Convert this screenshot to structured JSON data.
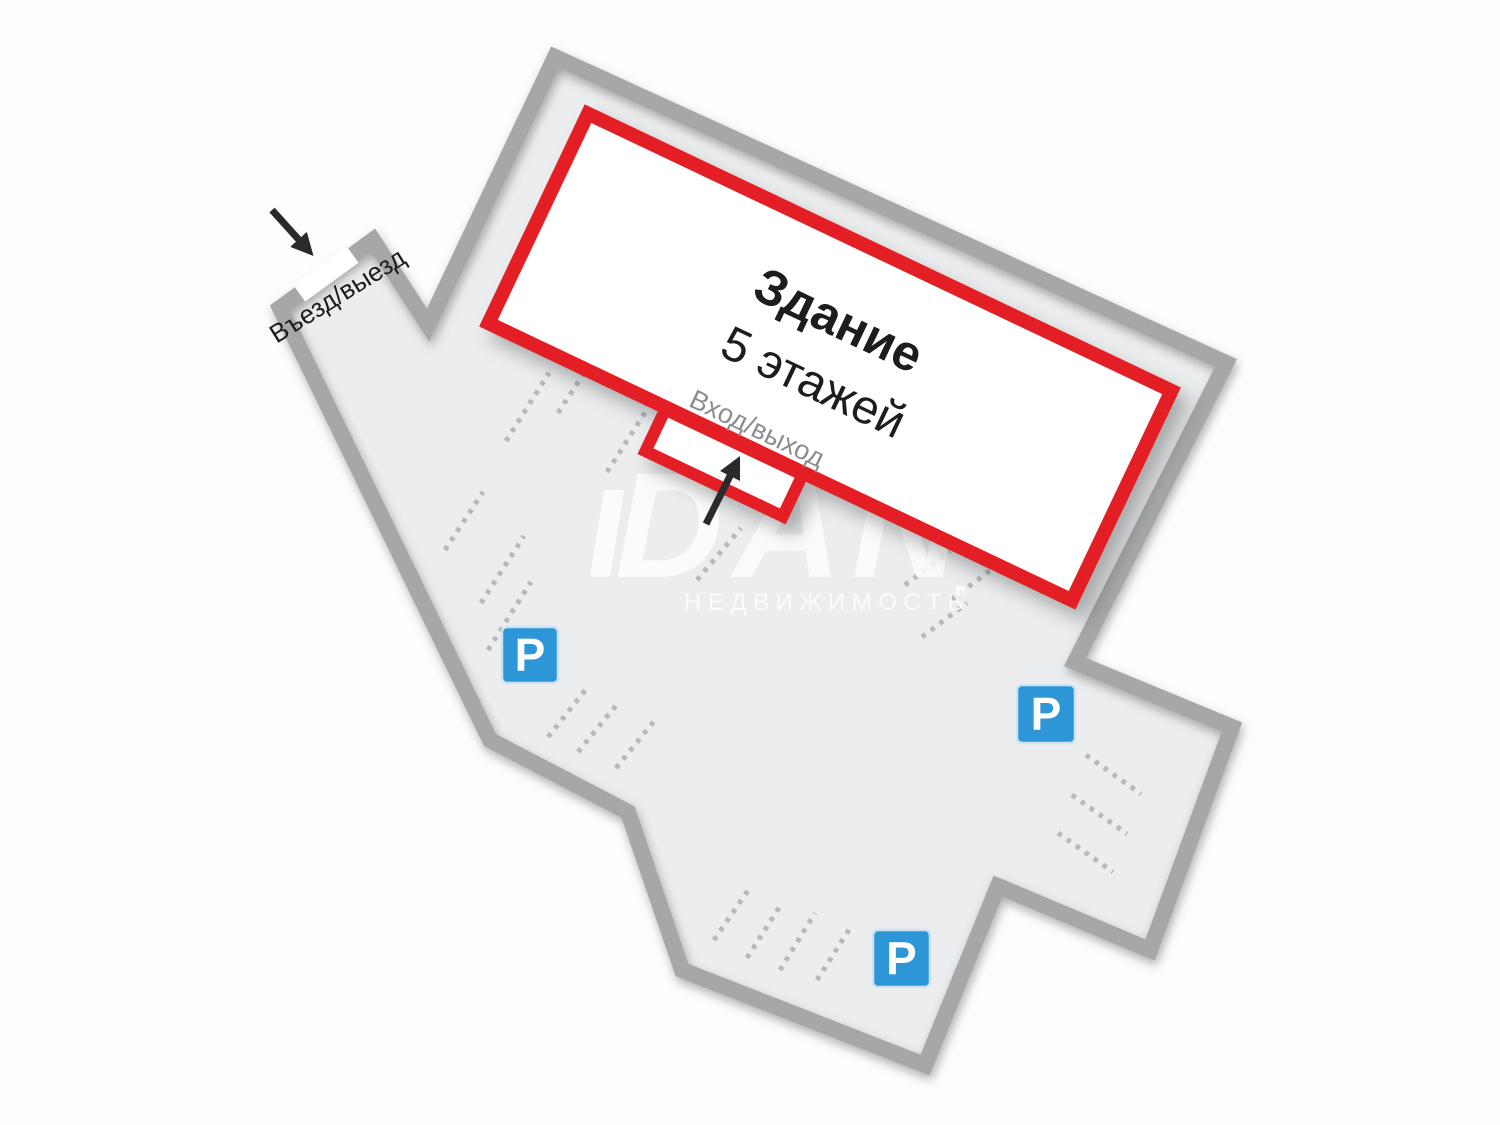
{
  "labels": {
    "gate": "Въезд/выезд",
    "building_title": "Здание",
    "building_floors": "5 этажей",
    "door": "Вход/выход",
    "parking": "P"
  },
  "watermark": {
    "logo": "DAN",
    "subtitle": "НЕДВИЖИМОСТЬ"
  },
  "colors": {
    "bg": "#fdfdfe",
    "site_fill": "#ebedee",
    "site_border": "#a6a7a8",
    "accent_red": "#e31e24",
    "parking_blue": "#2d96d6",
    "parking_blue_border": "#cde3f2",
    "dash_gray": "#b7b9ba",
    "text_dark": "#1d1d1f",
    "text_gray": "#8b8e91",
    "arrow_black": "#2a2a2c",
    "watermark_white": "#ffffff"
  },
  "diagram": {
    "site_outline_points": "555,57 1226,363 1075,662 1232,727 1150,950 998,886 925,1065 682,970 628,812 490,740 292,332 280,308 373,240 428,325",
    "building": {
      "cx": 830,
      "cy": 357,
      "w": 646,
      "h": 232,
      "angle": 25.4
    },
    "door_bump": {
      "cx": 724,
      "cy": 463,
      "w": 152,
      "h": 46,
      "angle": 25.4
    },
    "gate_slot": {
      "cx": 326,
      "cy": 274,
      "w": 66,
      "h": 20,
      "angle": -36
    },
    "gate_label_pos": {
      "x": 342,
      "y": 303,
      "angle": -32
    },
    "arrows": [
      {
        "name": "gate",
        "x1": 272,
        "y1": 210,
        "x2": 300,
        "y2": 241
      },
      {
        "name": "door",
        "x1": 706,
        "y1": 524,
        "x2": 731,
        "y2": 474
      }
    ],
    "p_signs": [
      {
        "x": 502,
        "y": 627,
        "s": 56
      },
      {
        "x": 1017,
        "y": 685,
        "s": 58
      },
      {
        "x": 873,
        "y": 930,
        "s": 57
      }
    ],
    "parking_rows": [
      [
        506,
        441,
        549,
        373
      ],
      [
        558,
        413,
        586,
        370
      ],
      [
        607,
        472,
        648,
        408
      ],
      [
        445,
        550,
        483,
        492
      ],
      [
        481,
        603,
        524,
        536
      ],
      [
        488,
        650,
        531,
        582
      ],
      [
        548,
        737,
        587,
        688
      ],
      [
        578,
        752,
        618,
        703
      ],
      [
        616,
        768,
        655,
        720
      ],
      [
        697,
        580,
        741,
        528
      ],
      [
        905,
        585,
        950,
        551
      ],
      [
        922,
        637,
        967,
        603
      ],
      [
        951,
        600,
        996,
        566
      ],
      [
        1086,
        755,
        1141,
        794
      ],
      [
        1072,
        795,
        1127,
        834
      ],
      [
        1058,
        833,
        1113,
        872
      ],
      [
        714,
        940,
        749,
        889
      ],
      [
        747,
        958,
        782,
        903
      ],
      [
        780,
        970,
        815,
        913
      ],
      [
        817,
        980,
        852,
        925
      ]
    ]
  }
}
